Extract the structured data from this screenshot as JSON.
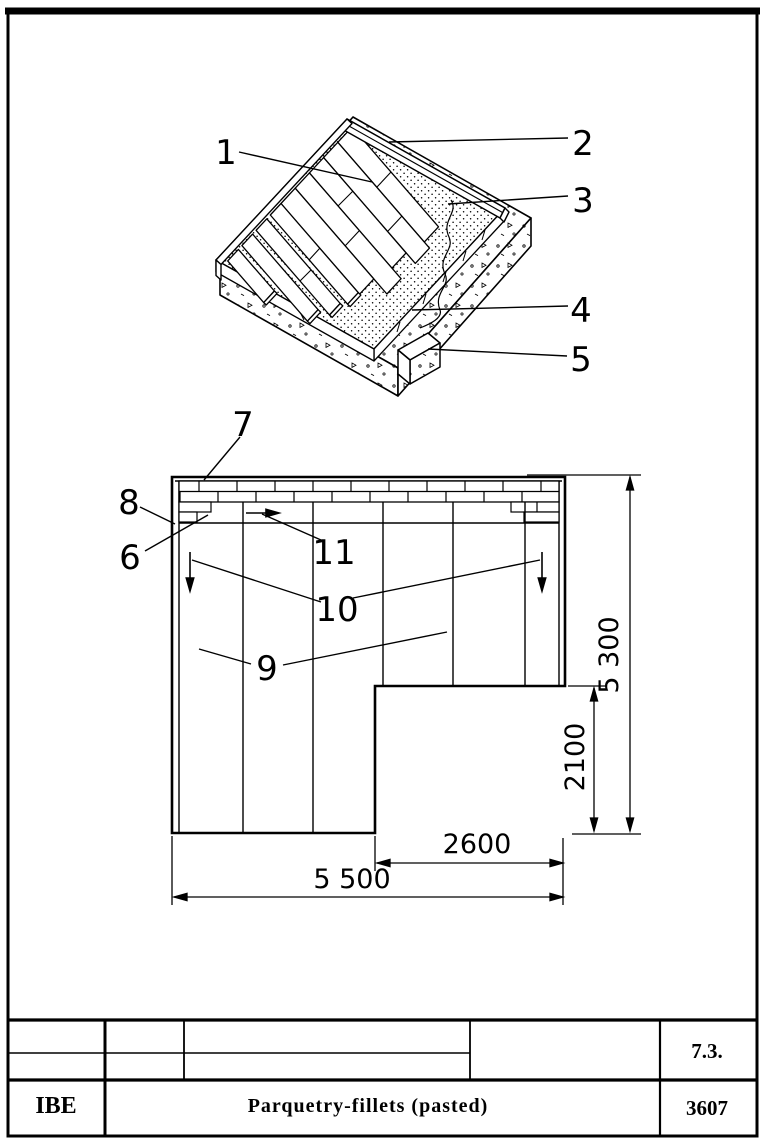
{
  "iso": {
    "labels": {
      "l1": "1",
      "l2": "2",
      "l3": "3",
      "l4": "4",
      "l5": "5"
    }
  },
  "plan": {
    "labels": {
      "l6": "6",
      "l7": "7",
      "l8": "8",
      "l9": "9",
      "l10": "10",
      "l11": "11"
    },
    "dims": {
      "total_width": "5 500",
      "recess_width": "2600",
      "recess_height": "2100",
      "total_height": "5 300"
    }
  },
  "title_block": {
    "org": "IBE",
    "title": "Parquetry-fillets  (pasted)",
    "section": "7.3.",
    "number": "3607"
  }
}
